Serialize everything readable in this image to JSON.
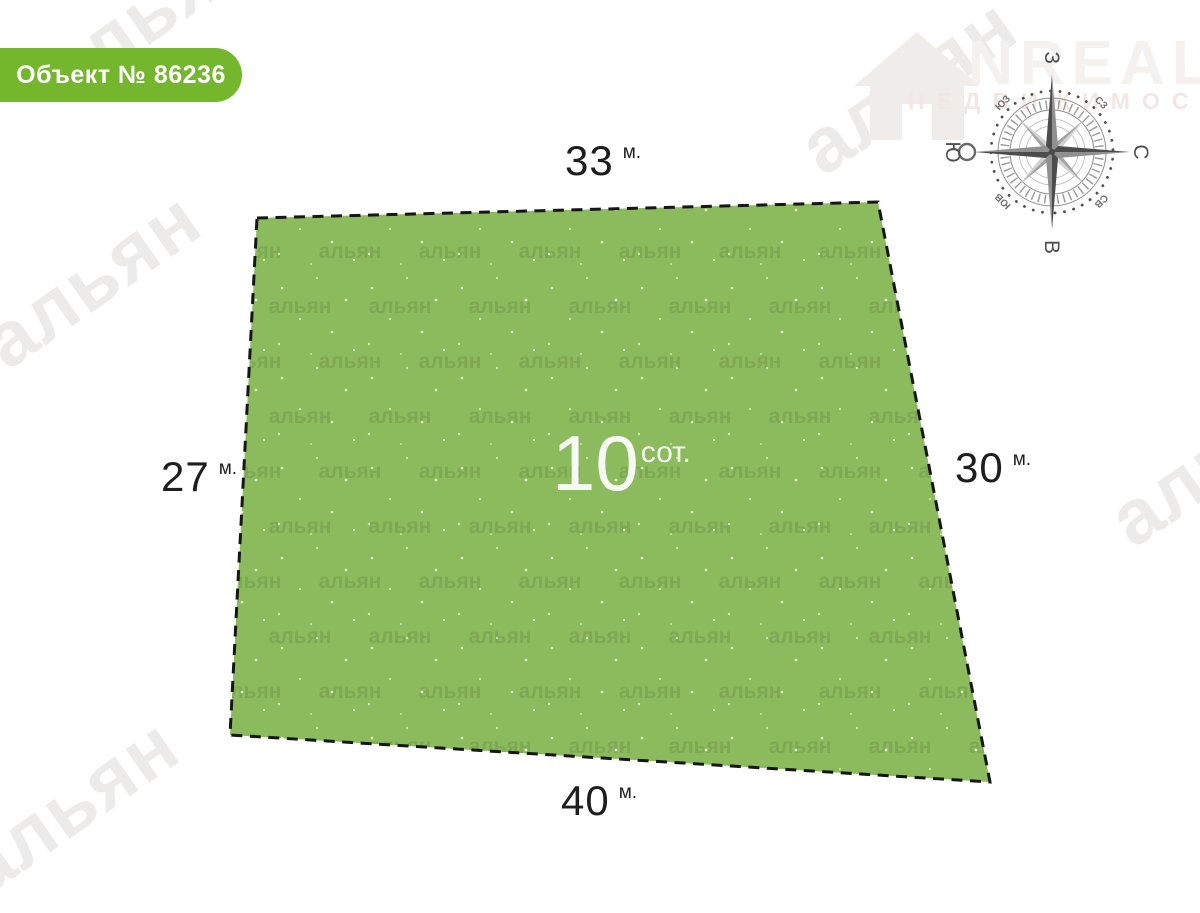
{
  "badge": {
    "label": "Объект № 86236"
  },
  "plot": {
    "area_value": "10",
    "area_unit": "сот.",
    "sides": {
      "top": {
        "value": "33",
        "unit": "м."
      },
      "left": {
        "value": "27",
        "unit": "м."
      },
      "right": {
        "value": "30",
        "unit": "м."
      },
      "bottom": {
        "value": "40",
        "unit": "м."
      }
    }
  },
  "compass": {
    "n": "С",
    "e": "В",
    "s": "Ю",
    "w": "З",
    "ne": "СВ",
    "se": "ЮВ",
    "sw": "ЮЗ",
    "nw": "СЗ"
  },
  "watermark": {
    "text": "альян"
  },
  "logo": {
    "name": "NREALT",
    "subtitle": "НЕДВИЖИМОСТЬ"
  },
  "colors": {
    "badge_green": "#74b62c",
    "plot_green": "#8cbb5d",
    "line_dark": "#161616"
  }
}
